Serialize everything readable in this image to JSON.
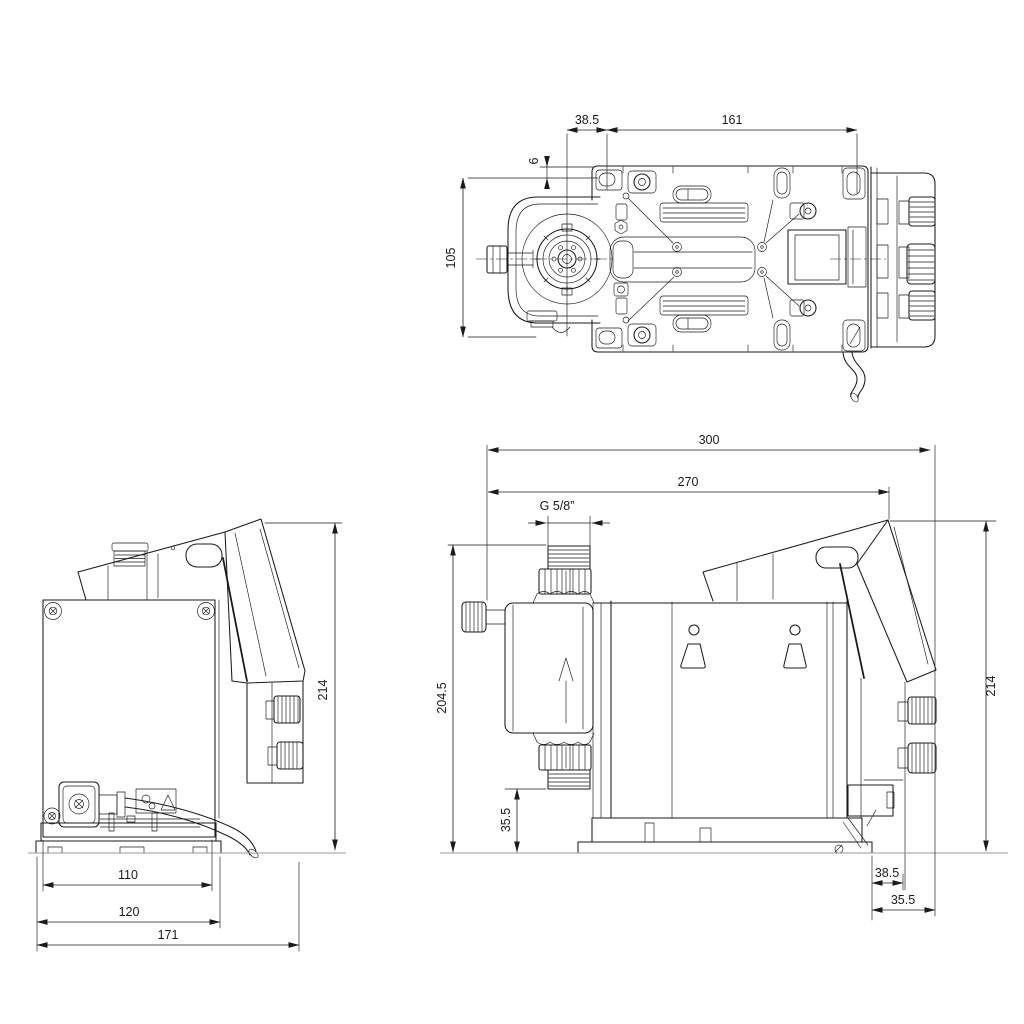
{
  "document": {
    "type": "pump dimensional drawing, three orthographic views",
    "background_color": "#ffffff",
    "line_color": "#1b1b1b",
    "ground_line_color": "#9a9a9a"
  },
  "views": {
    "top": {
      "label": "top view",
      "dims": {
        "back_offset": "38.5",
        "hole_spacing": "161",
        "edge_to_hole": "6",
        "hole_row_spacing": "105"
      }
    },
    "front": {
      "label": "front view",
      "dims": {
        "height": "214",
        "foot_width": "110",
        "base_width": "120",
        "depth": "171"
      }
    },
    "side": {
      "label": "side view",
      "dims": {
        "overall_length": "300",
        "length_to_panel": "270",
        "connection_thread": "G 5/8”",
        "connector_height": "204.5",
        "connector_clearance": "35.5",
        "height": "214",
        "rear_hole_offset": "38.5",
        "rear_overhang": "35.5"
      }
    }
  }
}
